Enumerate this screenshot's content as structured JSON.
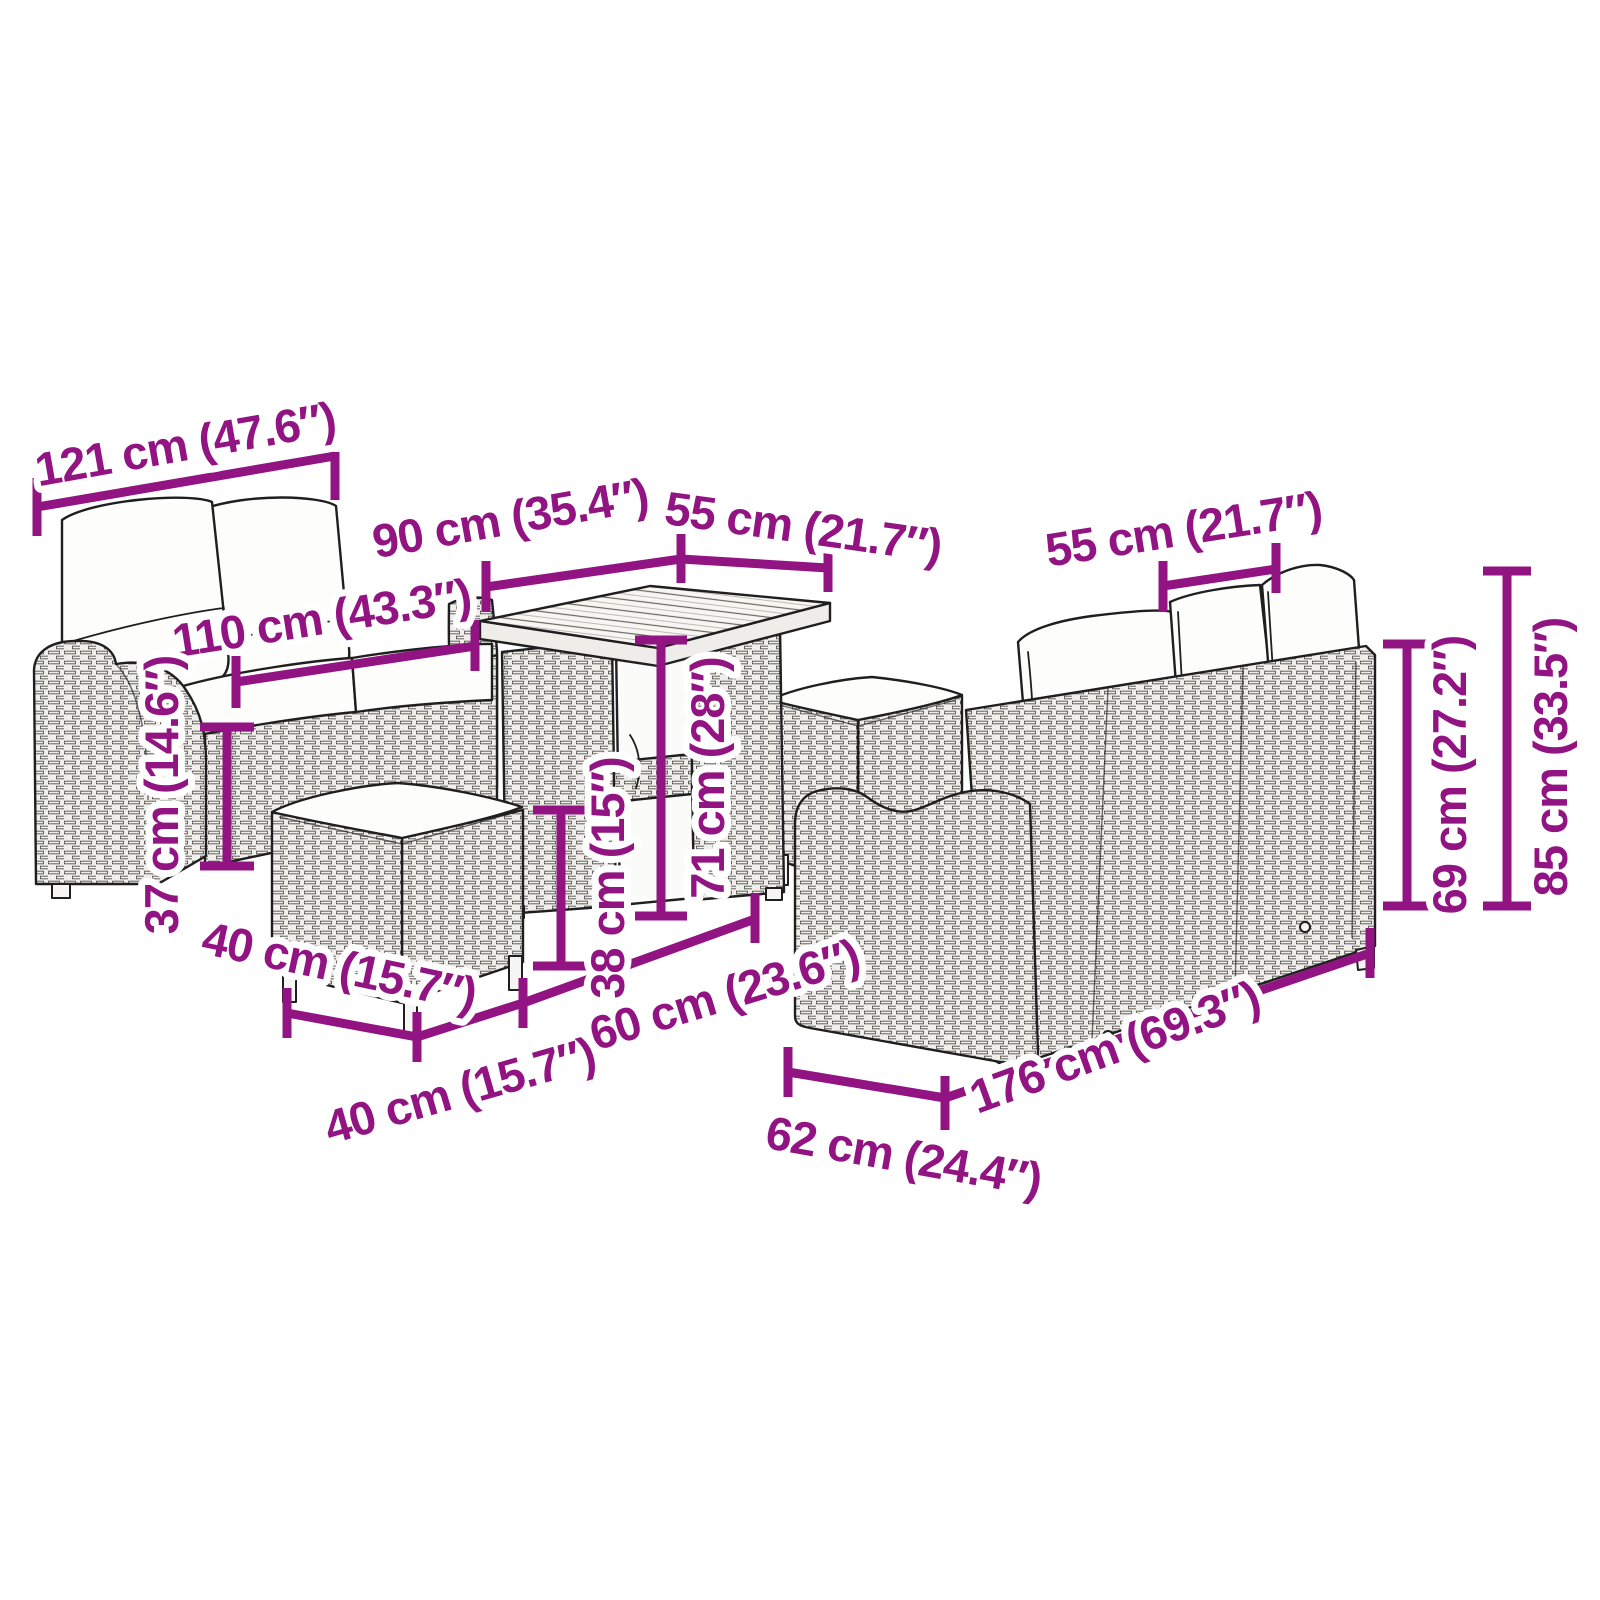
{
  "colors": {
    "dimension_accent": "#911482",
    "line_art": "#1f1f1f",
    "background": "#ffffff"
  },
  "diagram": {
    "type": "furniture-dimension-diagram",
    "pieces": [
      "two-seater-sofa",
      "dining-table",
      "stool-front",
      "stool-back",
      "three-seater-sofa"
    ]
  },
  "dimensions": {
    "sofa2_width": {
      "label": "121 cm (47.6″)"
    },
    "sofa2_seat_width": {
      "label": "110 cm (43.3″)"
    },
    "table_length": {
      "label": "90 cm (35.4″)"
    },
    "table_depth": {
      "label": "55 cm (21.7″)"
    },
    "table_height": {
      "label": "71 cm (28″)"
    },
    "stool_height": {
      "label": "38 cm (15″)"
    },
    "sofa2_seat_height": {
      "label": "37 cm (14.6″)"
    },
    "stool_width": {
      "label": "40 cm (15.7″)"
    },
    "stool_depth": {
      "label": "40 cm (15.7″)"
    },
    "sofa3_seat_depth": {
      "label": "60 cm (23.6″)"
    },
    "sofa3_depth": {
      "label": "62 cm (24.4″)"
    },
    "sofa3_width": {
      "label": "176 cm (69.3″)"
    },
    "sofa3_cushion_width": {
      "label": "55 cm (21.7″)"
    },
    "sofa3_back_height": {
      "label": "69 cm (27.2″)"
    },
    "sofa3_total_height": {
      "label": "85 cm (33.5″)"
    }
  }
}
